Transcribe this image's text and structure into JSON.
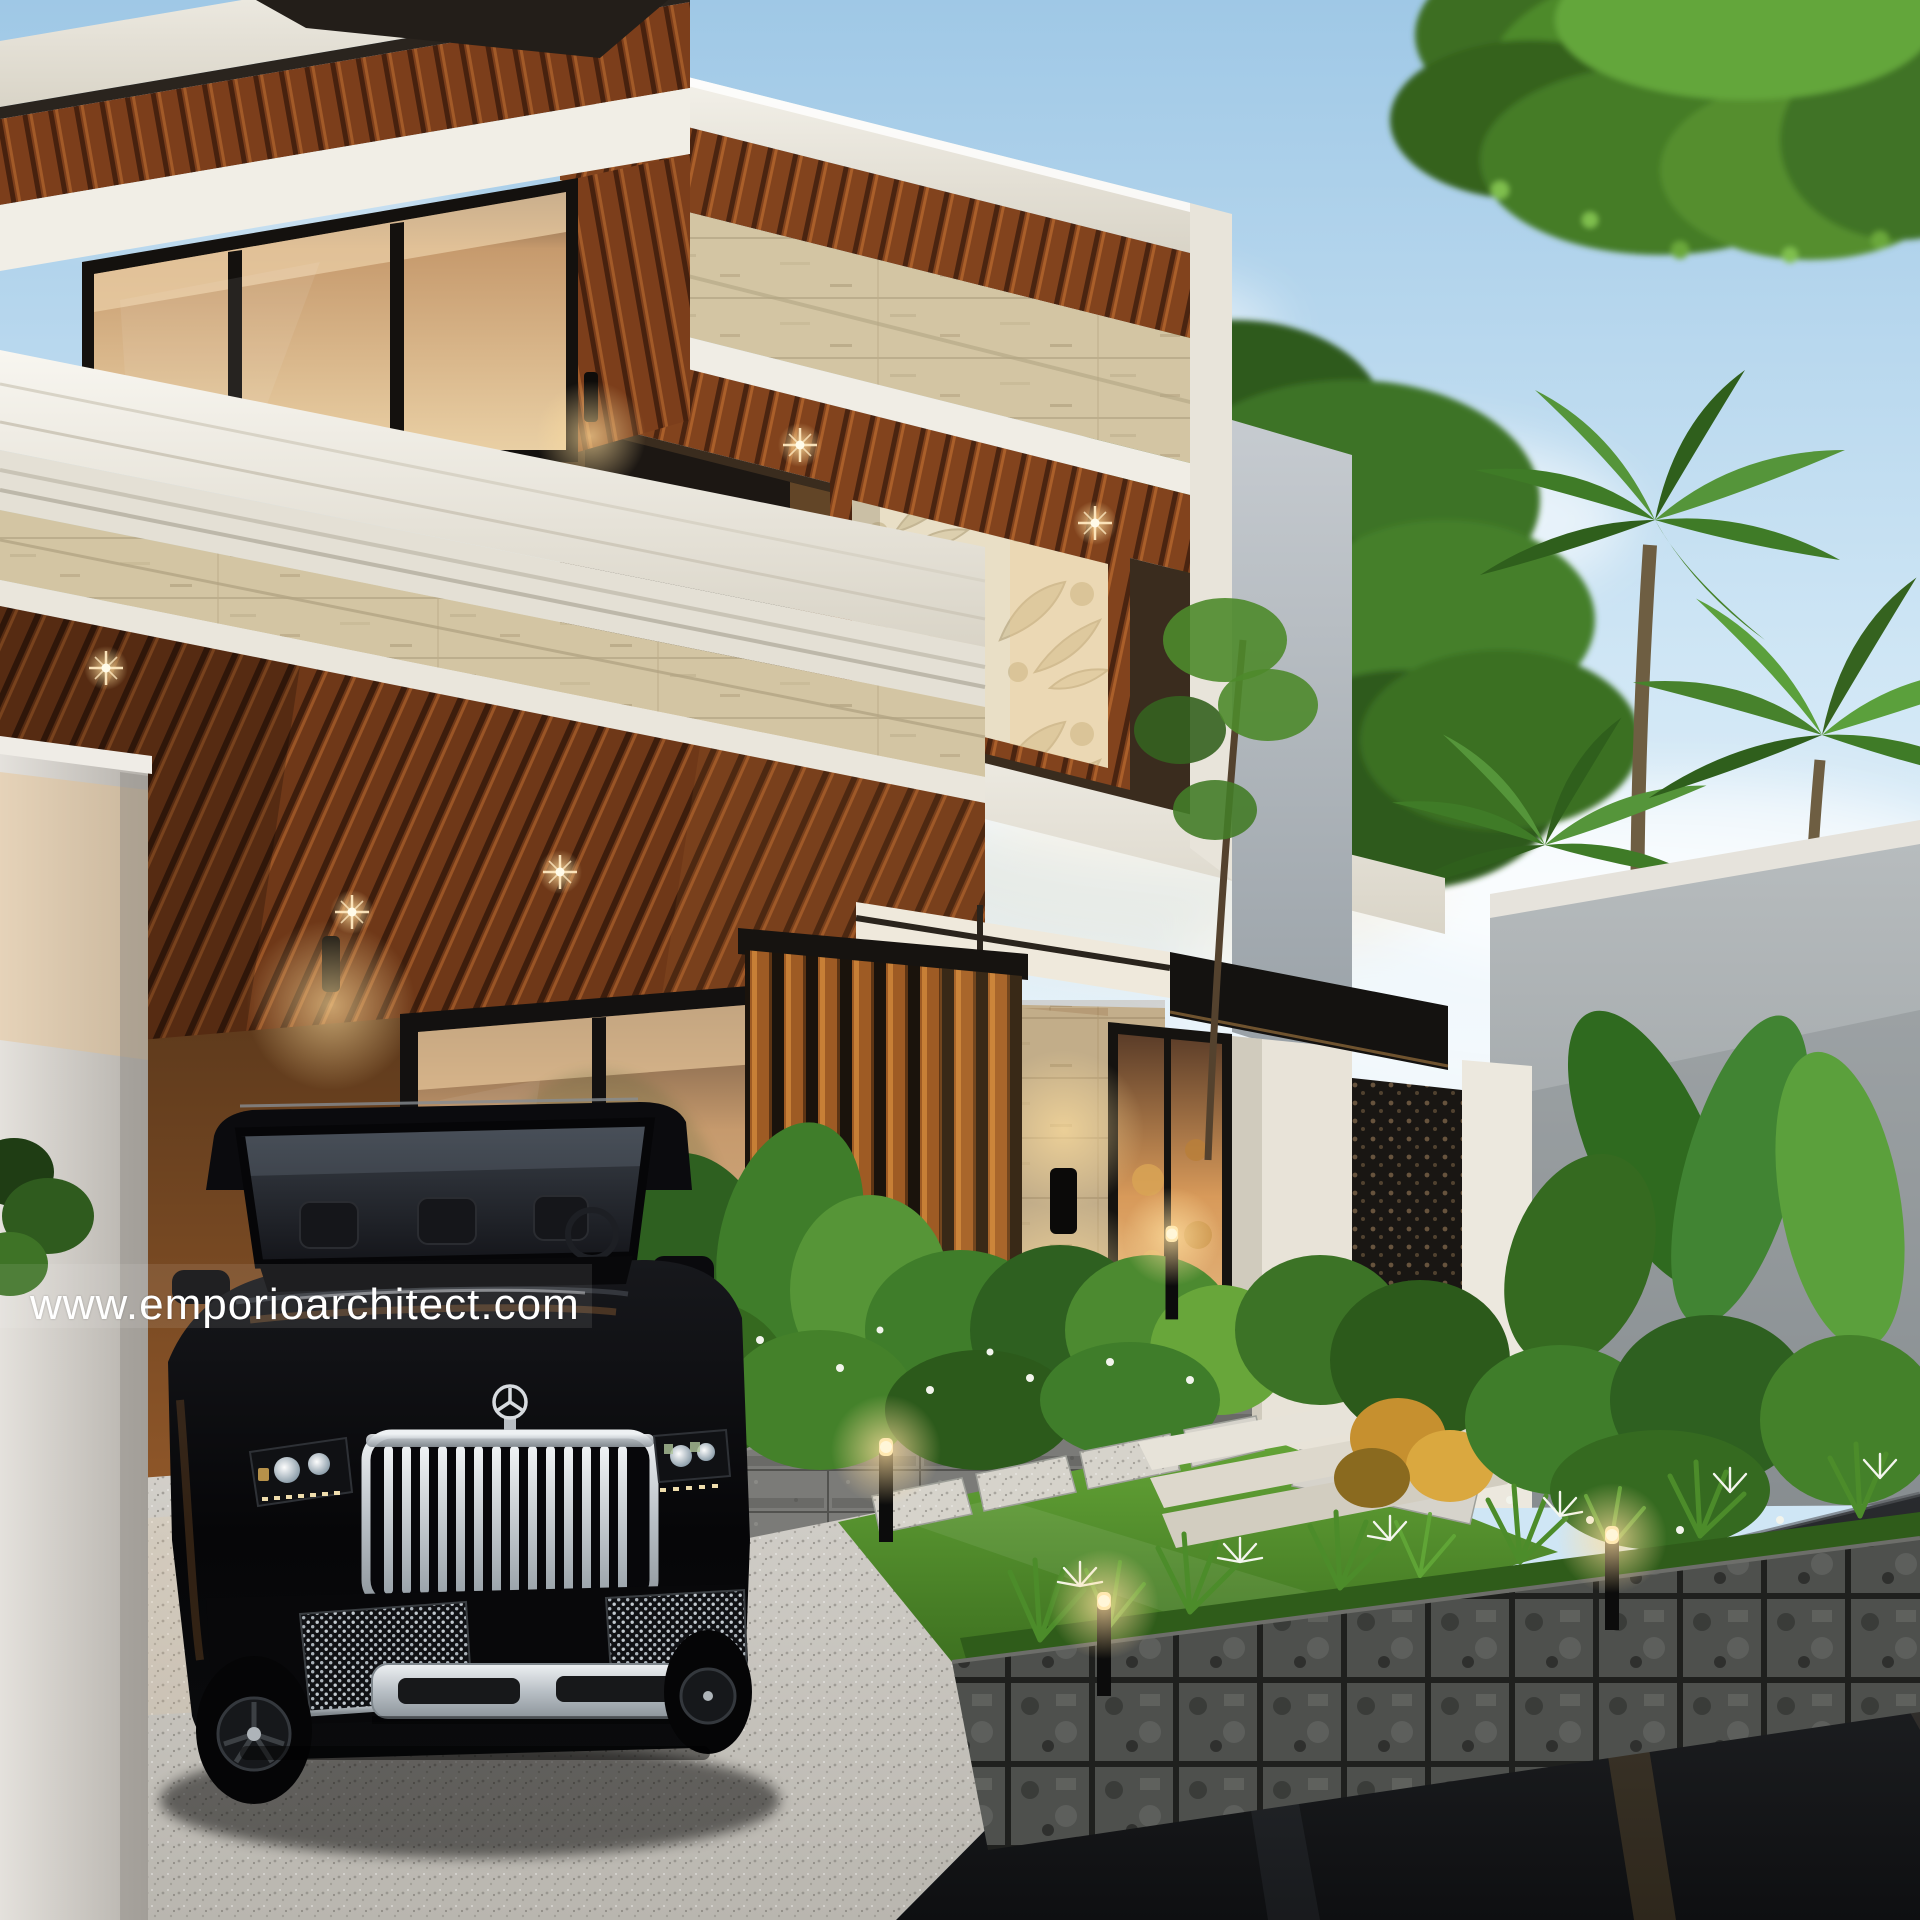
{
  "image": {
    "kind": "architectural exterior render",
    "description": "Modern tropical two-storey house at dusk with wood slat soffits, travertine walls, carved stone relief panel, black luxury SUV in the carport, tropical garden with bollard lights, palms and a dark asphalt street.",
    "watermark_text": "www.emporioarchitect.com"
  },
  "palette": {
    "sky_top": "#9fc8e6",
    "sky_horizon": "#eff7fc",
    "fascia_white": "#f4f1ea",
    "wood_dark": "#5e3014",
    "wood_mid": "#8a4a22",
    "wood_light": "#c07c36",
    "travertine": "#d3c5a3",
    "carved_panel": "#e9dfc6",
    "interior_warm": "#d89a5a",
    "light_warm": "#ffdf9e",
    "foliage_dark": "#2e5a1e",
    "foliage_mid": "#4e8a2b",
    "foliage_light": "#79b544",
    "lawn_green": "#4b8427",
    "planter_stone": "#4e504d",
    "driveway_concrete": "#cac8c2",
    "road_asphalt": "#17181a",
    "car_black": "#0b0b0d",
    "chrome": "#d8dce0",
    "boundary_wall_grey": "#9aa0a5"
  },
  "scene": {
    "house": {
      "storeys": 2,
      "materials": [
        "white painted fascia",
        "wood slat soffit",
        "travertine stone",
        "carved stone relief",
        "black framed glass",
        "vertical wood louvres"
      ],
      "lighting": [
        "recessed warm downlights",
        "black cylinder wall sconces"
      ]
    },
    "vehicle": {
      "type": "black luxury SUV",
      "emblem": "three-pointed star hood ornament",
      "grille": "vertical chrome slats",
      "position": "parked in carport"
    },
    "garden": {
      "features": [
        "tropical shrubs",
        "white spider lilies",
        "lawn with stepping stones",
        "stone block planter walls",
        "bollard lights",
        "palm trees",
        "entry steps"
      ]
    },
    "ground": {
      "driveway": "light speckled concrete",
      "street": "dark wet asphalt with reflections"
    }
  }
}
